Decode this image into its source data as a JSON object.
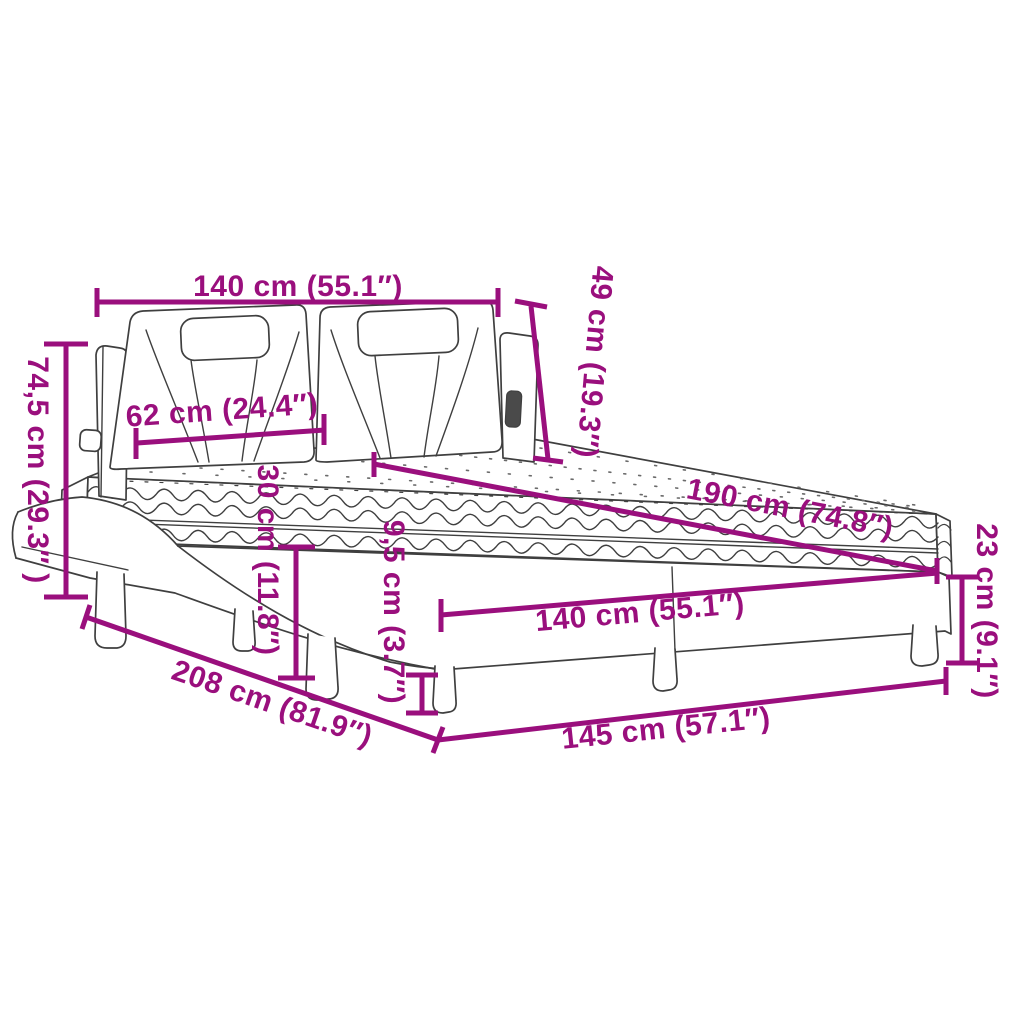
{
  "diagram": {
    "type": "product-dimension-diagram",
    "subject": "bed-with-headboard-and-mattress",
    "colors": {
      "dimension_accent": "#9A0F7D",
      "line_art": "#3F3F3F",
      "background": "#FFFFFF"
    },
    "dimensions": [
      {
        "name": "headboard-width",
        "label": "140 cm (55.1″)"
      },
      {
        "name": "headboard-height",
        "label": "49 cm (19.3″)"
      },
      {
        "name": "overall-height",
        "label": "74,5 cm (29.3″ )"
      },
      {
        "name": "headboard-cushion-width",
        "label": "62 cm (24.4″)"
      },
      {
        "name": "side-rail-height",
        "label": "30 cm (11.8″)"
      },
      {
        "name": "mattress-length",
        "label": "190 cm (74.8″)"
      },
      {
        "name": "leg-height",
        "label": "9,5 cm (3.7″)"
      },
      {
        "name": "base-height",
        "label": "23 cm (9.1″)"
      },
      {
        "name": "mattress-width",
        "label": "140 cm (55.1″)"
      },
      {
        "name": "overall-length",
        "label": "208 cm (81.9″)"
      },
      {
        "name": "base-width",
        "label": "145 cm (57.1″)"
      }
    ]
  }
}
